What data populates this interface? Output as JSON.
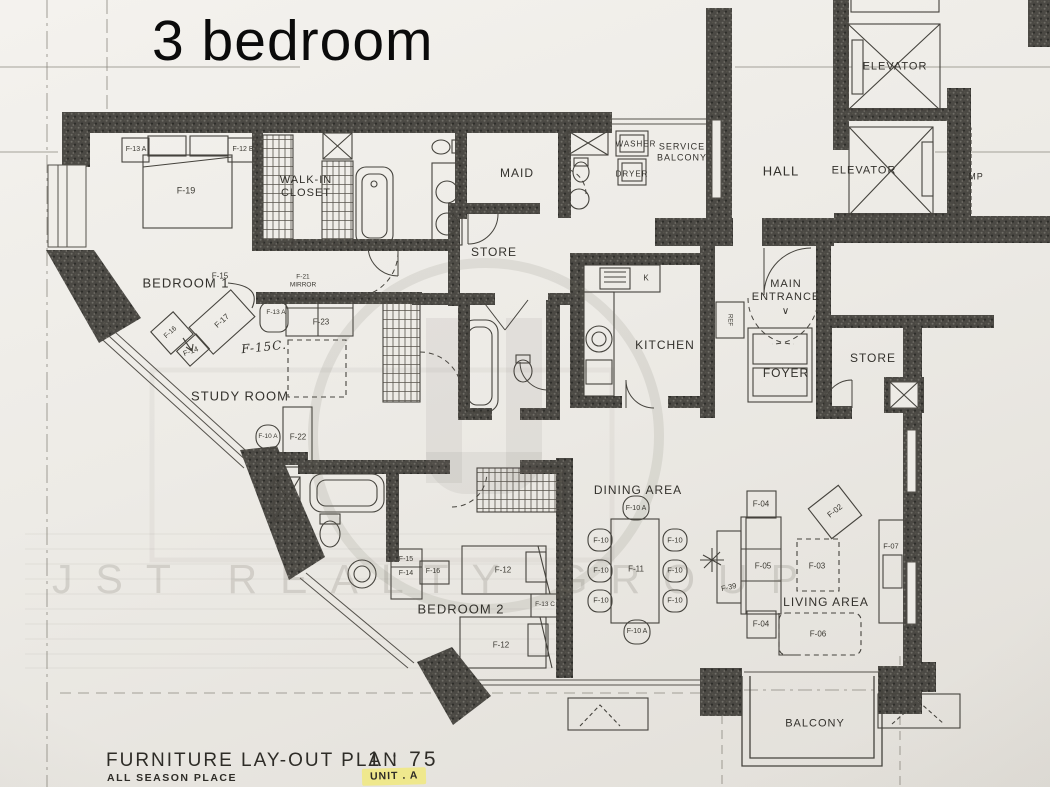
{
  "title": "3 bedroom",
  "watermark": {
    "text": "JST REALTY GROUP"
  },
  "footer": {
    "plan_title": "FURNITURE LAY-OUT PLAN",
    "scale": "1 : 75",
    "project": "ALL SEASON PLACE",
    "unit": "UNIT . A"
  },
  "colors": {
    "paper": "#edebe6",
    "wall": "#4a4843",
    "ink": "#3b3933",
    "highlight": "#efe88d"
  },
  "plan": {
    "room_labels": [
      {
        "t": "BEDROOM 1",
        "x": 186,
        "y": 283,
        "fs": 13
      },
      {
        "t": "WALK-IN\nCLOSET",
        "x": 306,
        "y": 187,
        "fs": 11
      },
      {
        "t": "MAID",
        "x": 517,
        "y": 173,
        "fs": 12
      },
      {
        "t": "STORE",
        "x": 494,
        "y": 252,
        "fs": 12,
        "n": "room-label-store-upper"
      },
      {
        "t": "WASHER",
        "x": 636,
        "y": 144,
        "fs": 8
      },
      {
        "t": "SERVICE\nBALCONY",
        "x": 682,
        "y": 152,
        "fs": 9
      },
      {
        "t": "DRYER",
        "x": 632,
        "y": 174,
        "fs": 8
      },
      {
        "t": "HALL",
        "x": 781,
        "y": 171,
        "fs": 13
      },
      {
        "t": "ELEVATOR",
        "x": 895,
        "y": 67,
        "fs": 11,
        "n": "room-label-elevator-1"
      },
      {
        "t": "ELEVATOR",
        "x": 864,
        "y": 171,
        "fs": 11,
        "n": "room-label-elevator-2"
      },
      {
        "t": "MP",
        "x": 976,
        "y": 177,
        "fs": 9
      },
      {
        "t": "KITCHEN",
        "x": 665,
        "y": 345,
        "fs": 12
      },
      {
        "t": "MAIN\nENTRANCE",
        "x": 786,
        "y": 291,
        "fs": 11
      },
      {
        "t": "∨",
        "x": 786,
        "y": 312,
        "fs": 10,
        "n": "main-entrance-arrow"
      },
      {
        "t": "FOYER",
        "x": 786,
        "y": 373,
        "fs": 12
      },
      {
        "t": "STORE",
        "x": 873,
        "y": 358,
        "fs": 12,
        "n": "room-label-store-right"
      },
      {
        "t": "STUDY ROOM",
        "x": 240,
        "y": 396,
        "fs": 13
      },
      {
        "t": "DINING AREA",
        "x": 638,
        "y": 490,
        "fs": 12
      },
      {
        "t": "LIVING AREA",
        "x": 826,
        "y": 602,
        "fs": 12
      },
      {
        "t": "BEDROOM 2",
        "x": 461,
        "y": 609,
        "fs": 13
      },
      {
        "t": "BALCONY",
        "x": 815,
        "y": 724,
        "fs": 11
      }
    ],
    "furniture_labels": [
      {
        "t": "F-13 A",
        "x": 136,
        "y": 150,
        "fs": 7
      },
      {
        "t": "F-12 B",
        "x": 243,
        "y": 150,
        "fs": 7
      },
      {
        "t": "F-19",
        "x": 186,
        "y": 191,
        "fs": 9
      },
      {
        "t": "F-15",
        "x": 220,
        "y": 276
      },
      {
        "t": "F-17",
        "x": 222,
        "y": 321,
        "r": -42
      },
      {
        "t": "F-16",
        "x": 171,
        "y": 333,
        "r": -42,
        "fs": 7
      },
      {
        "t": "F-14",
        "x": 191,
        "y": 352,
        "r": -20,
        "fs": 7.5
      },
      {
        "t": "F-21\nMIRROR",
        "x": 303,
        "y": 281,
        "fs": 6.5,
        "n": "furniture-label-f-21-mirror"
      },
      {
        "t": "F-13 A",
        "x": 276,
        "y": 313,
        "fs": 6.5
      },
      {
        "t": "F-23",
        "x": 321,
        "y": 322
      },
      {
        "t": "F-15C.",
        "x": 264,
        "y": 347,
        "c": "hand",
        "fs": 12,
        "r": -6
      },
      {
        "t": "F-10 A",
        "x": 268,
        "y": 437,
        "fs": 6.5
      },
      {
        "t": "F-22",
        "x": 298,
        "y": 437
      },
      {
        "t": "F-15",
        "x": 406,
        "y": 560,
        "fs": 7
      },
      {
        "t": "F-14",
        "x": 406,
        "y": 574,
        "fs": 7
      },
      {
        "t": "F-16",
        "x": 433,
        "y": 572,
        "fs": 7
      },
      {
        "t": "F-12",
        "x": 503,
        "y": 570
      },
      {
        "t": "F-13 C",
        "x": 545,
        "y": 605,
        "fs": 6.5
      },
      {
        "t": "F-12",
        "x": 501,
        "y": 645
      },
      {
        "t": "F-10 A",
        "x": 636,
        "y": 509,
        "fs": 7
      },
      {
        "t": "F-10",
        "x": 601,
        "y": 541,
        "fs": 7.5
      },
      {
        "t": "F-10",
        "x": 601,
        "y": 571,
        "fs": 7.5
      },
      {
        "t": "F-10",
        "x": 601,
        "y": 601,
        "fs": 7.5
      },
      {
        "t": "F-10",
        "x": 675,
        "y": 541,
        "fs": 7.5
      },
      {
        "t": "F-10",
        "x": 675,
        "y": 571,
        "fs": 7.5
      },
      {
        "t": "F-10",
        "x": 675,
        "y": 601,
        "fs": 7.5
      },
      {
        "t": "F-11",
        "x": 636,
        "y": 569
      },
      {
        "t": "F-10 A",
        "x": 637,
        "y": 632,
        "fs": 7
      },
      {
        "t": "F-04",
        "x": 761,
        "y": 504
      },
      {
        "t": "F-05",
        "x": 763,
        "y": 566
      },
      {
        "t": "F-39",
        "x": 729,
        "y": 588,
        "r": -12,
        "fs": 7.5
      },
      {
        "t": "F-02",
        "x": 835,
        "y": 511,
        "r": -38
      },
      {
        "t": "F-03",
        "x": 817,
        "y": 566
      },
      {
        "t": "F-04",
        "x": 761,
        "y": 624
      },
      {
        "t": "F-06",
        "x": 818,
        "y": 634
      },
      {
        "t": "F-07",
        "x": 891,
        "y": 547,
        "fs": 7.5
      },
      {
        "t": "K",
        "x": 646,
        "y": 278,
        "fs": 8,
        "n": "furniture-label-kitchen-sink-k"
      },
      {
        "t": "REF",
        "x": 729,
        "y": 320,
        "fs": 6,
        "r": 90,
        "n": "furniture-label-refrigerator"
      }
    ]
  }
}
